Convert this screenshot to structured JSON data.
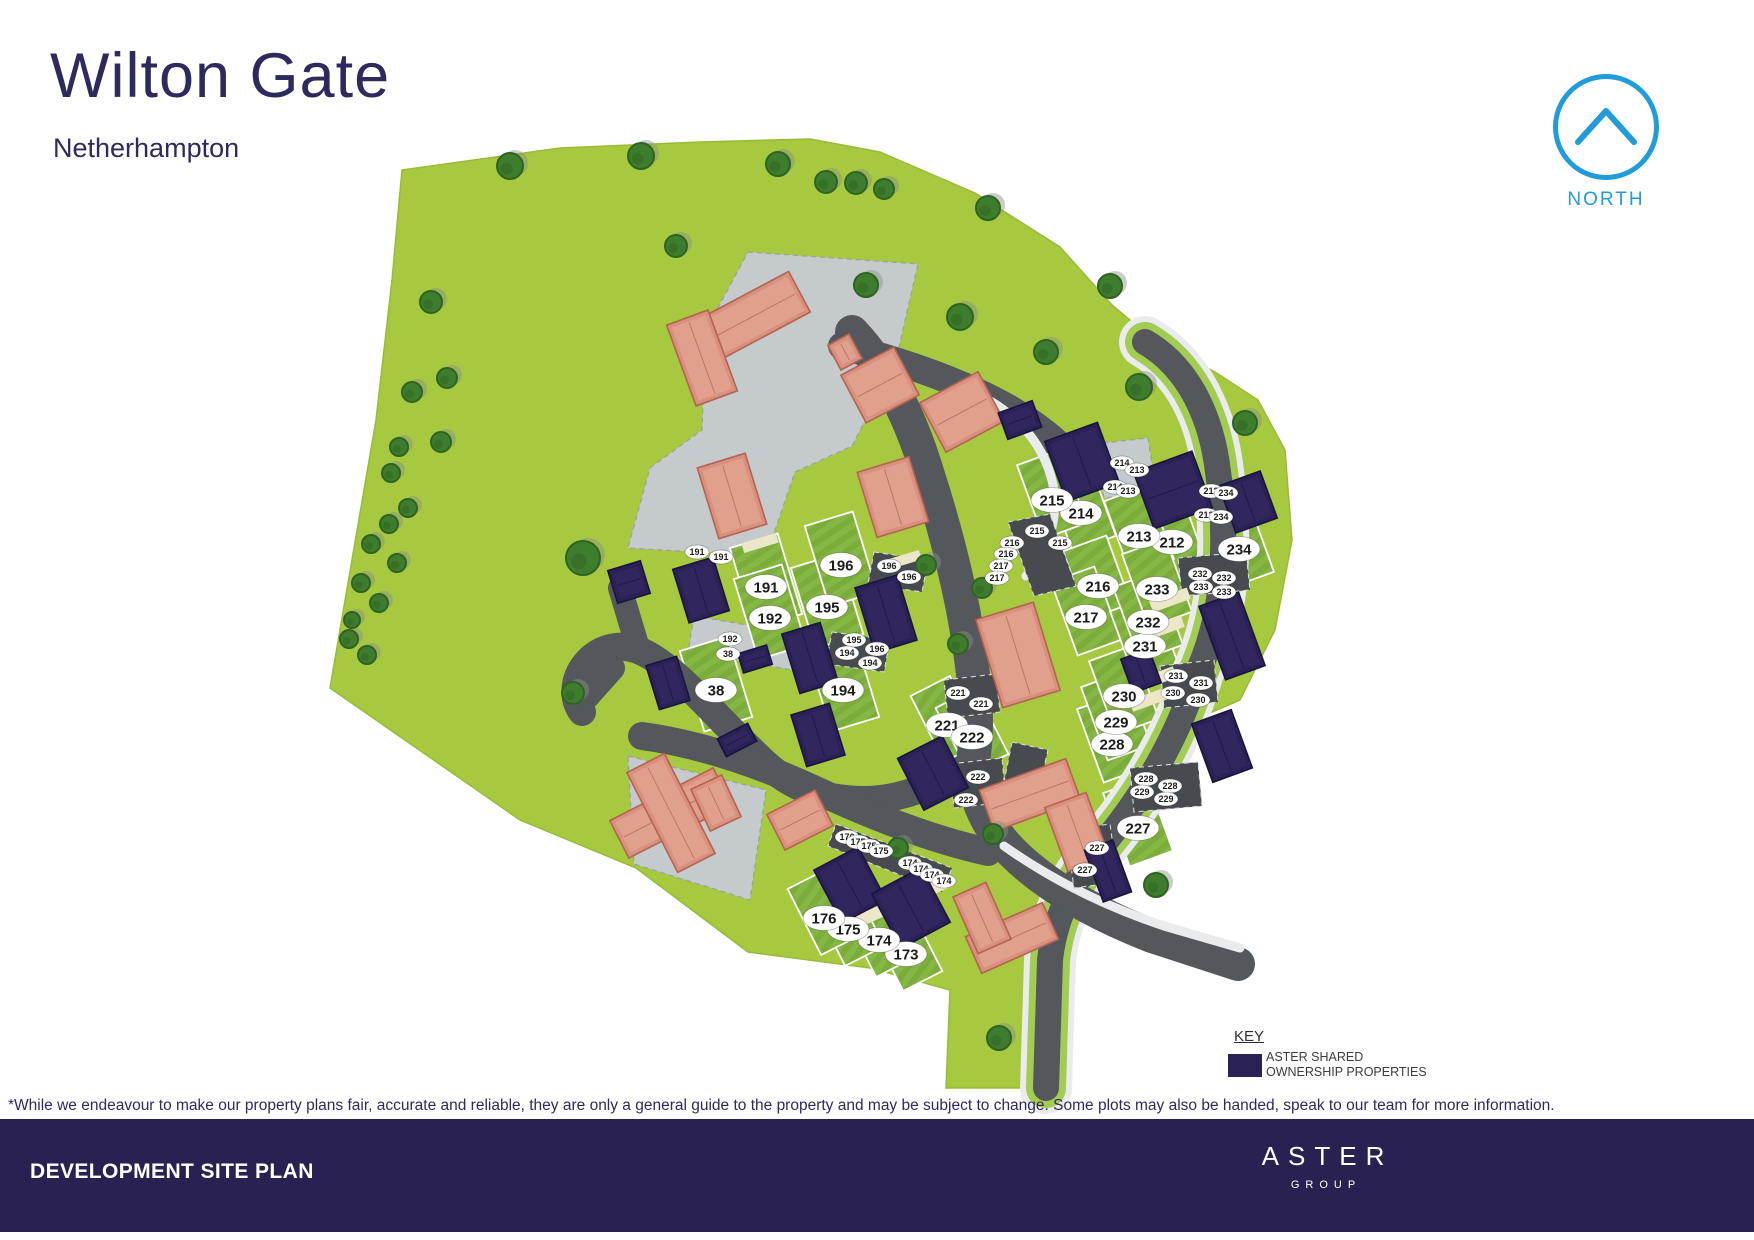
{
  "header": {
    "title": "Wilton Gate",
    "subtitle": "Netherhampton"
  },
  "north": {
    "label": "NORTH",
    "color": "#1f9cd9"
  },
  "key": {
    "title": "KEY",
    "swatch_color": "#2a2156",
    "line1": "ASTER SHARED",
    "line2": "OWNERSHIP PROPERTIES"
  },
  "disclaimer": "*While we endeavour to make our property plans fair, accurate and reliable, they are only a general guide to the property and may be subject to change. Some plots may also be handed, speak to our team for more information.",
  "footer": {
    "title": "DEVELOPMENT SITE PLAN",
    "brand": "ASTER",
    "brand_sub": "GROUP",
    "bg": "#2a2153"
  },
  "site_plan": {
    "colors": {
      "field": "#a6c93f",
      "fieldEdge": "#98bc37",
      "parcel": "#7cad3a",
      "parcelStripe": "#85b744",
      "road": "#54575c",
      "courtLight": "#c5cacd",
      "courtDark": "#474a4e",
      "verge": "#a3cc52",
      "sidewalk": "#e9ebed",
      "cream": "#ece7c9",
      "navy": "#2a2156",
      "navyEdge": "#1a1440",
      "navyHi": "#372b66",
      "salmon": "#d9907e",
      "salmonEdge": "#b4634f",
      "salmonHi": "#e7ab9a",
      "tree": "#3f7d2e",
      "treeEdge": "#2e6321",
      "treeShadow": "#8a9188",
      "labelFill": "#ffffff",
      "labelText": "#1c1c1a"
    },
    "parcel_styles": {
      "L": {
        "a": -17,
        "w": 50,
        "h": 84
      },
      "R": {
        "a": -20,
        "w": 46,
        "h": 78
      },
      "B": {
        "a": -27,
        "w": 44,
        "h": 74
      }
    },
    "plots": [
      {
        "id": "38",
        "x": 716,
        "y": 690,
        "g": "L"
      },
      {
        "id": "173",
        "x": 906,
        "y": 954,
        "g": "B"
      },
      {
        "id": "174",
        "x": 879,
        "y": 940,
        "g": "B"
      },
      {
        "id": "175",
        "x": 848,
        "y": 929,
        "g": "B"
      },
      {
        "id": "176",
        "x": 824,
        "y": 918,
        "g": "B"
      },
      {
        "id": "191",
        "x": 766,
        "y": 587,
        "g": "L"
      },
      {
        "id": "192",
        "x": 770,
        "y": 618,
        "g": "L"
      },
      {
        "id": "194",
        "x": 843,
        "y": 690,
        "g": "L"
      },
      {
        "id": "195",
        "x": 827,
        "y": 607,
        "g": "L"
      },
      {
        "id": "196",
        "x": 841,
        "y": 565,
        "g": "L"
      },
      {
        "id": "212",
        "x": 1172,
        "y": 542,
        "g": "R"
      },
      {
        "id": "213",
        "x": 1139,
        "y": 536,
        "g": "R"
      },
      {
        "id": "214",
        "x": 1081,
        "y": 513,
        "g": "R"
      },
      {
        "id": "215",
        "x": 1052,
        "y": 500,
        "g": "R"
      },
      {
        "id": "216",
        "x": 1098,
        "y": 586,
        "g": "R"
      },
      {
        "id": "217",
        "x": 1086,
        "y": 617,
        "g": "R"
      },
      {
        "id": "221",
        "x": 947,
        "y": 725,
        "g": "B"
      },
      {
        "id": "222",
        "x": 972,
        "y": 737,
        "g": "B"
      },
      {
        "id": "227",
        "x": 1138,
        "y": 828,
        "g": "R"
      },
      {
        "id": "228",
        "x": 1112,
        "y": 744,
        "g": "R"
      },
      {
        "id": "229",
        "x": 1116,
        "y": 722,
        "g": "R"
      },
      {
        "id": "230",
        "x": 1124,
        "y": 696,
        "g": "R"
      },
      {
        "id": "231",
        "x": 1145,
        "y": 646,
        "g": "R"
      },
      {
        "id": "232",
        "x": 1148,
        "y": 622,
        "g": "R"
      },
      {
        "id": "233",
        "x": 1157,
        "y": 589,
        "g": "R"
      },
      {
        "id": "234",
        "x": 1239,
        "y": 549,
        "g": "R"
      }
    ],
    "parking_labels": [
      [
        "191",
        697,
        552
      ],
      [
        "191",
        721,
        557
      ],
      [
        "192",
        730,
        639
      ],
      [
        "38",
        728,
        654
      ],
      [
        "195",
        854,
        640
      ],
      [
        "196",
        877,
        649
      ],
      [
        "194",
        847,
        653
      ],
      [
        "194",
        870,
        663
      ],
      [
        "196",
        889,
        566
      ],
      [
        "196",
        909,
        577
      ],
      [
        "215",
        1037,
        531
      ],
      [
        "215",
        1060,
        543
      ],
      [
        "216",
        1012,
        543
      ],
      [
        "216",
        1006,
        554
      ],
      [
        "217",
        1001,
        566
      ],
      [
        "217",
        997,
        578
      ],
      [
        "214",
        1122,
        463
      ],
      [
        "213",
        1137,
        470
      ],
      [
        "214",
        1115,
        487
      ],
      [
        "213",
        1128,
        491
      ],
      [
        "212",
        1211,
        491
      ],
      [
        "234",
        1226,
        493
      ],
      [
        "212",
        1206,
        515
      ],
      [
        "234",
        1221,
        517
      ],
      [
        "232",
        1200,
        574
      ],
      [
        "232",
        1224,
        578
      ],
      [
        "233",
        1201,
        587
      ],
      [
        "233",
        1224,
        592
      ],
      [
        "231",
        1176,
        676
      ],
      [
        "231",
        1201,
        683
      ],
      [
        "230",
        1173,
        693
      ],
      [
        "230",
        1198,
        700
      ],
      [
        "228",
        1146,
        779
      ],
      [
        "228",
        1170,
        786
      ],
      [
        "229",
        1142,
        792
      ],
      [
        "229",
        1166,
        799
      ],
      [
        "221",
        958,
        693
      ],
      [
        "221",
        981,
        704
      ],
      [
        "222",
        978,
        777
      ],
      [
        "222",
        966,
        800
      ],
      [
        "227",
        1097,
        848
      ],
      [
        "227",
        1085,
        870
      ],
      [
        "176",
        847,
        837
      ],
      [
        "175",
        858,
        842
      ],
      [
        "175",
        869,
        846
      ],
      [
        "175",
        881,
        851
      ],
      [
        "174",
        910,
        863
      ],
      [
        "174",
        921,
        869
      ],
      [
        "174",
        932,
        875
      ],
      [
        "174",
        944,
        881
      ]
    ],
    "buildings": {
      "navy": [
        [
          629,
          582,
          34,
          34,
          -17
        ],
        [
          701,
          590,
          42,
          56,
          -17
        ],
        [
          668,
          683,
          32,
          46,
          -17
        ],
        [
          755,
          659,
          30,
          20,
          -17
        ],
        [
          810,
          658,
          40,
          62,
          -17
        ],
        [
          818,
          735,
          40,
          54,
          -17
        ],
        [
          886,
          614,
          44,
          68,
          -17
        ],
        [
          737,
          740,
          34,
          20,
          -27
        ],
        [
          850,
          885,
          50,
          60,
          -28
        ],
        [
          911,
          908,
          56,
          62,
          -28
        ],
        [
          933,
          773,
          50,
          58,
          -27
        ],
        [
          1020,
          420,
          36,
          28,
          -20
        ],
        [
          1082,
          462,
          56,
          64,
          -20
        ],
        [
          1173,
          490,
          62,
          60,
          -20
        ],
        [
          1248,
          502,
          44,
          50,
          -20
        ],
        [
          1232,
          636,
          42,
          78,
          -20
        ],
        [
          1141,
          671,
          30,
          36,
          -20
        ],
        [
          1222,
          746,
          42,
          62,
          -20
        ],
        [
          1108,
          871,
          30,
          55,
          -20
        ]
      ],
      "salmon": [
        [
          750,
          318,
          112,
          46,
          -28
        ],
        [
          702,
          358,
          44,
          86,
          -20
        ],
        [
          845,
          352,
          24,
          28,
          -28
        ],
        [
          880,
          385,
          60,
          54,
          -28
        ],
        [
          962,
          412,
          66,
          56,
          -28
        ],
        [
          732,
          496,
          50,
          74,
          -17
        ],
        [
          893,
          497,
          54,
          68,
          -17
        ],
        [
          1018,
          655,
          60,
          92,
          -17
        ],
        [
          1030,
          795,
          92,
          44,
          -20
        ],
        [
          1077,
          832,
          44,
          68,
          -20
        ],
        [
          671,
          813,
          116,
          42,
          -27
        ],
        [
          671,
          813,
          42,
          112,
          -27
        ],
        [
          716,
          803,
          34,
          46,
          -25
        ],
        [
          800,
          820,
          54,
          40,
          -27
        ],
        [
          1012,
          938,
          84,
          40,
          -24
        ],
        [
          982,
          918,
          36,
          62,
          -24
        ]
      ]
    },
    "trees": [
      [
        510,
        166,
        13
      ],
      [
        641,
        156,
        13
      ],
      [
        778,
        164,
        12
      ],
      [
        826,
        182,
        11
      ],
      [
        856,
        183,
        11
      ],
      [
        884,
        189,
        10
      ],
      [
        988,
        208,
        12
      ],
      [
        1110,
        286,
        12
      ],
      [
        676,
        246,
        11
      ],
      [
        866,
        285,
        12
      ],
      [
        960,
        317,
        13
      ],
      [
        1046,
        352,
        12
      ],
      [
        1139,
        387,
        13
      ],
      [
        1245,
        423,
        12
      ],
      [
        583,
        558,
        17
      ],
      [
        926,
        565,
        10
      ],
      [
        982,
        588,
        10
      ],
      [
        958,
        644,
        10
      ],
      [
        898,
        848,
        10
      ],
      [
        993,
        834,
        10
      ],
      [
        1156,
        885,
        12
      ],
      [
        573,
        693,
        11
      ],
      [
        999,
        1038,
        12
      ],
      [
        431,
        302,
        11
      ],
      [
        447,
        378,
        10
      ],
      [
        412,
        392,
        10
      ],
      [
        441,
        442,
        10
      ],
      [
        399,
        447,
        9
      ],
      [
        391,
        473,
        9
      ],
      [
        408,
        508,
        9
      ],
      [
        389,
        524,
        9
      ],
      [
        371,
        544,
        9
      ],
      [
        397,
        563,
        9
      ],
      [
        361,
        583,
        9
      ],
      [
        379,
        603,
        9
      ],
      [
        349,
        639,
        9
      ],
      [
        367,
        655,
        9
      ],
      [
        352,
        620,
        8
      ]
    ]
  }
}
